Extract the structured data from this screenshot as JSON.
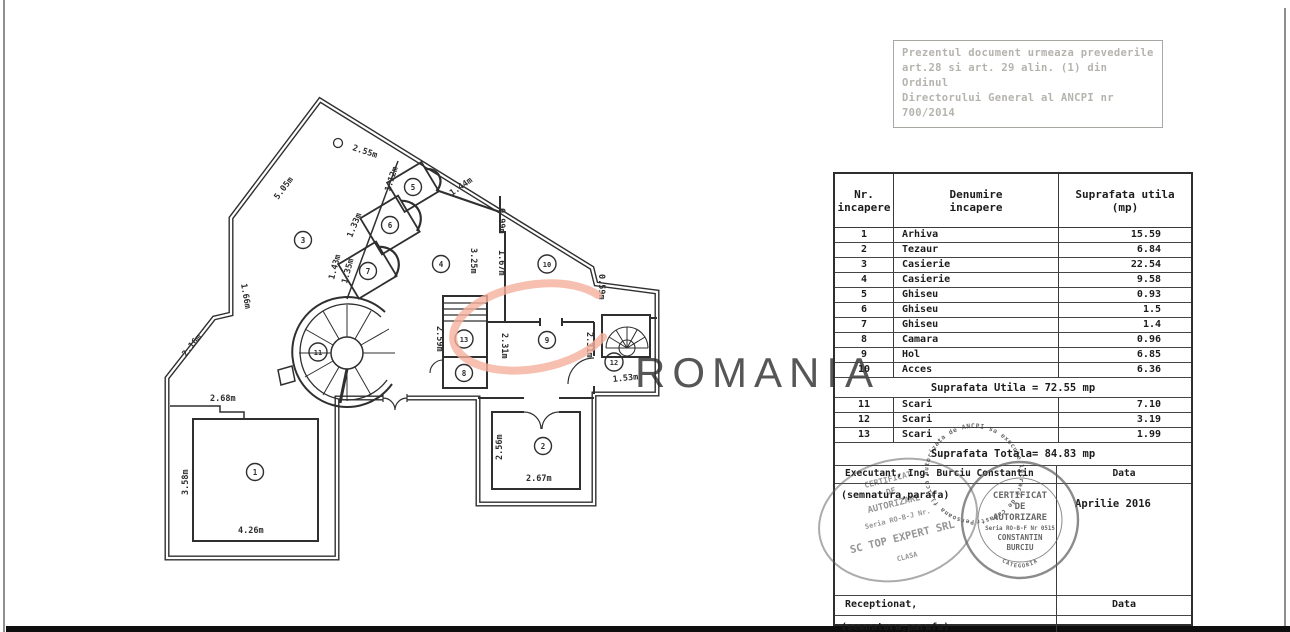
{
  "page": {
    "note_box": {
      "line1": "Prezentul document urmeaza prevederile",
      "line2": "art.28 si art. 29 alin. (1) din Ordinul",
      "line3": "Directorului General al ANCPI nr",
      "line4": "700/2014"
    },
    "watermark": {
      "text": "ROMANIA",
      "color": "#f5b09c"
    }
  },
  "plan": {
    "rooms": [
      "1",
      "2",
      "3",
      "4",
      "5",
      "6",
      "7",
      "8",
      "9",
      "10",
      "11",
      "12",
      "13"
    ],
    "dims": [
      "2.55m",
      "5.05m",
      "1.66m",
      "2.16m",
      "2.68m",
      "3.58m",
      "4.26m",
      "1.12m",
      "1.44m",
      "1.33m",
      "1.43m",
      "1.35m",
      "3.25m",
      "0.99m",
      "1.67m",
      "0.59m",
      "2.59m",
      "2.31m",
      "2.31m",
      "1.53m",
      "2.56m",
      "2.67m"
    ]
  },
  "table": {
    "header": {
      "c1a": "Nr.",
      "c1b": "incapere",
      "c2a": "Denumire",
      "c2b": "incapere",
      "c3a": "Suprafata utila",
      "c3b": "(mp)"
    },
    "rows": [
      {
        "nr": "1",
        "name": "Arhiva",
        "area": "15.59"
      },
      {
        "nr": "2",
        "name": "Tezaur",
        "area": "6.84"
      },
      {
        "nr": "3",
        "name": "Casierie",
        "area": "22.54"
      },
      {
        "nr": "4",
        "name": "Casierie",
        "area": "9.58"
      },
      {
        "nr": "5",
        "name": "Ghiseu",
        "area": "0.93"
      },
      {
        "nr": "6",
        "name": "Ghiseu",
        "area": "1.5"
      },
      {
        "nr": "7",
        "name": "Ghiseu",
        "area": "1.4"
      },
      {
        "nr": "8",
        "name": "Camara",
        "area": "0.96"
      },
      {
        "nr": "9",
        "name": "Hol",
        "area": "6.85"
      },
      {
        "nr": "10",
        "name": "Acces",
        "area": "6.36"
      }
    ],
    "utila_total": "Suprafata Utila = 72.55 mp",
    "scari_rows": [
      {
        "nr": "11",
        "name": "Scari",
        "area": "7.10"
      },
      {
        "nr": "12",
        "name": "Scari",
        "area": "3.19"
      },
      {
        "nr": "13",
        "name": "Scari",
        "area": "1.99"
      }
    ],
    "totala": "Suprafata Totala= 84.83 mp",
    "executant": "Executant, Ing. Burciu Constantin",
    "data_label": "Data",
    "semnatura": "(semnatura,parafa)",
    "date_value": "Aprilie 2016",
    "receptionat": "Receptionat,",
    "data_label2": "Data",
    "semnatura2": "(semnatura,parafa)"
  },
  "stamps": {
    "round": {
      "l1": "CERTIFICAT",
      "l2": "DE",
      "l3": "AUTORIZARE",
      "l4": "Seria RO-B-F Nr 0515",
      "l5": "CONSTANTIN",
      "l6": "BURCIU",
      "l7": "CATEGORIA",
      "ring": "Persoana fizica autorizata de ANCPI sa execute lucrari de cadastru geodezie si cartografie"
    },
    "oval": {
      "l1": "CERTIFICAT",
      "l2": "DE",
      "l3": "AUTORIZARE",
      "l4": "Seria RO-B-J Nr.",
      "l5": "SC TOP EXPERT SRL",
      "l6": "CLASA"
    }
  }
}
